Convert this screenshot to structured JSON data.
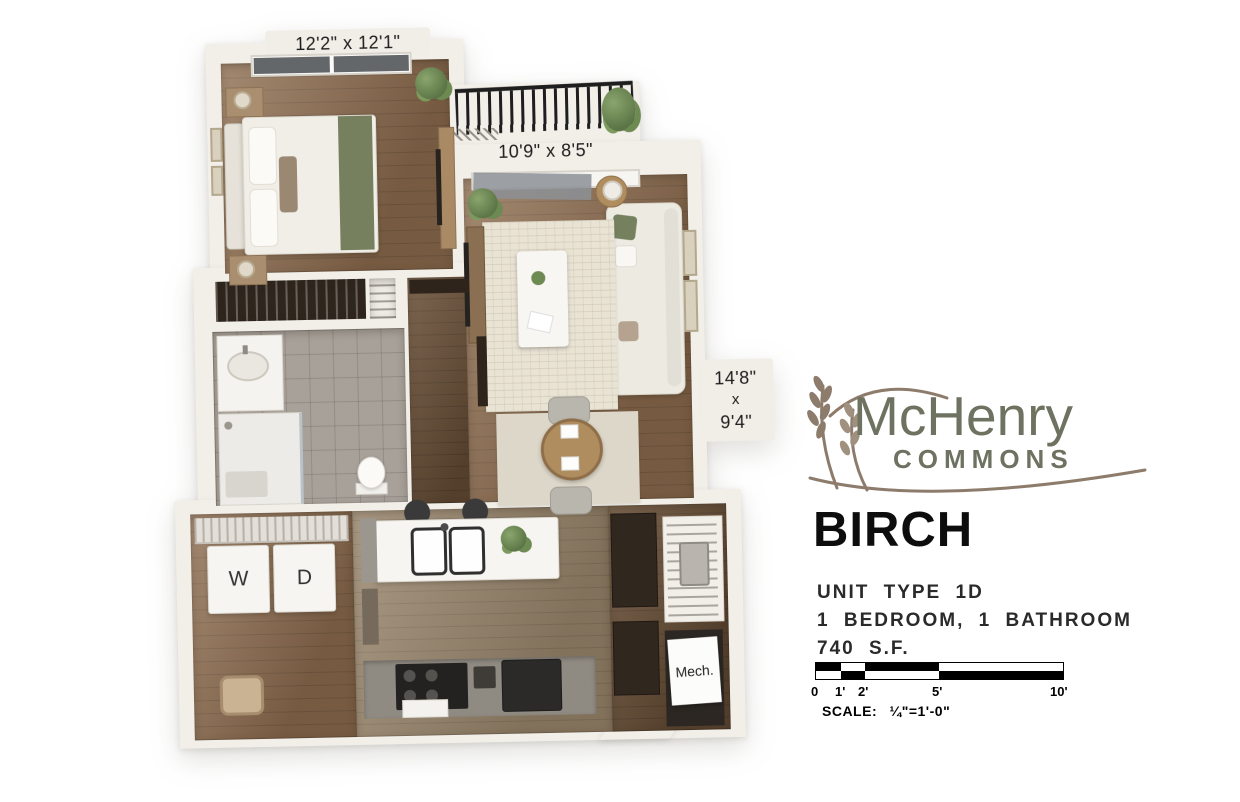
{
  "plan": {
    "bedroom_dim": "12'2\" x 12'1\"",
    "balcony_dim": "10'9\" x 8'5\"",
    "living_dim": [
      "14'8\"",
      "x",
      "9'4\""
    ],
    "washer": "W",
    "dryer": "D",
    "mech": "Mech."
  },
  "brand": {
    "name": "McHenry",
    "sub": "COMMONS"
  },
  "unit": {
    "name": "BIRCH",
    "type": "UNIT TYPE 1D",
    "config": "1 BEDROOM, 1 BATHROOM",
    "area": "740 S.F."
  },
  "scale_bar": {
    "ticks": [
      "0",
      "1'",
      "2'",
      "5'",
      "10'"
    ],
    "label": "SCALE:",
    "ratio": "¼\"=1'-0\""
  },
  "colors": {
    "brand_olive": "#6e7260",
    "wheat_taupe": "#8d7c6c",
    "wall_cream": "#f2efe9",
    "wood_floor": "#8d6c4e",
    "sage_accent": "#76805e",
    "text_black": "#0d0d0d"
  }
}
